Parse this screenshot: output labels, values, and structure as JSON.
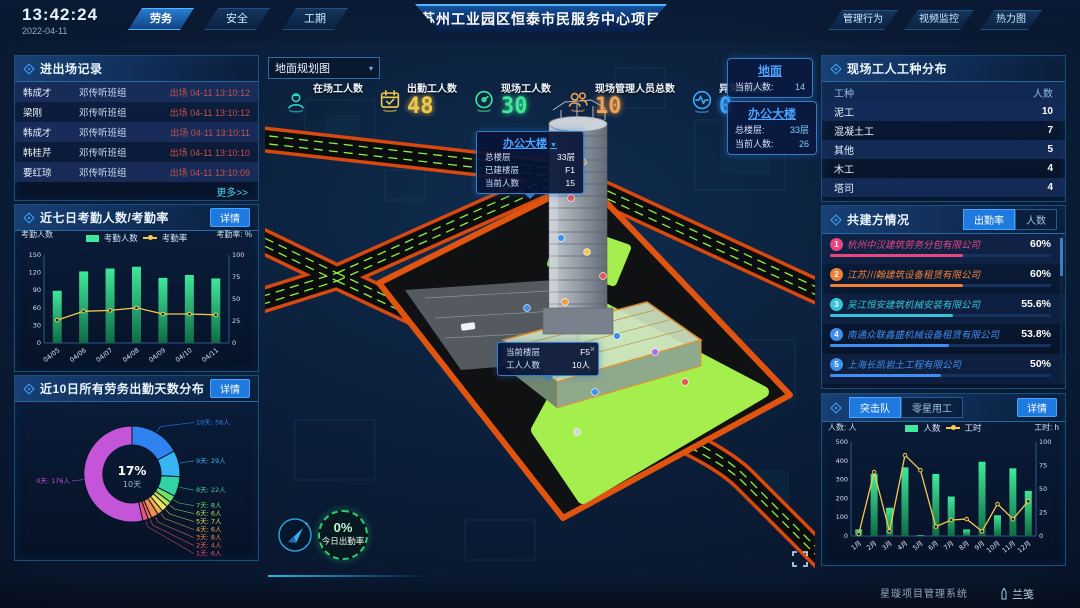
{
  "header": {
    "time": "13:42:24",
    "date": "2022-04-11",
    "nav_tabs": [
      "劳务",
      "安全",
      "工期"
    ],
    "title": "苏州工业园区恒泰市民服务中心项目",
    "right_tabs": [
      "管理行为",
      "视频监控",
      "热力图"
    ]
  },
  "entry_exit_panel": {
    "title": "进出场记录",
    "more_label": "更多>>",
    "rows": [
      {
        "name": "韩成才",
        "group": "邓传听班组",
        "status": "出场 04-11 13:10:12"
      },
      {
        "name": "梁刚",
        "group": "邓传听班组",
        "status": "出场 04-11 13:10:12"
      },
      {
        "name": "韩成才",
        "group": "邓传听班组",
        "status": "出场 04-11 13:10:11"
      },
      {
        "name": "韩桂芹",
        "group": "邓传听班组",
        "status": "出场 04-11 13:10:10"
      },
      {
        "name": "要红琼",
        "group": "邓传听班组",
        "status": "出场 04-11 13:10:09"
      }
    ]
  },
  "attendance_panel": {
    "title": "近七日考勤人数/考勤率",
    "detail_label": "详情"
  },
  "distribution_panel": {
    "title": "近10日所有劳务出勤天数分布",
    "detail_label": "详情"
  },
  "worker_type_panel": {
    "title": "现场工人工种分布",
    "headers": [
      "工种",
      "人数"
    ],
    "rows": [
      [
        "泥工",
        "10"
      ],
      [
        "混凝土工",
        "7"
      ],
      [
        "其他",
        "5"
      ],
      [
        "木工",
        "4"
      ],
      [
        "塔司",
        "4"
      ]
    ]
  },
  "partners_panel": {
    "title": "共建方情况",
    "tabs": [
      "出勤率",
      "人数"
    ],
    "active_tab": "出勤率",
    "rows": [
      {
        "rank": "1",
        "name": "杭州中汉建筑劳务分包有限公司",
        "percent": "60%",
        "value": 60,
        "color": "#e8467c"
      },
      {
        "rank": "2",
        "name": "江苏川翰建筑设备租赁有限公司",
        "percent": "60%",
        "value": 60,
        "color": "#f08038"
      },
      {
        "rank": "3",
        "name": "吴江恒安建筑机械安装有限公司",
        "percent": "55.6%",
        "value": 55.6,
        "color": "#35c5d8"
      },
      {
        "rank": "4",
        "name": "南通众联鑫盛机械设备租赁有限公司",
        "percent": "53.8%",
        "value": 53.8,
        "color": "#3f8ef0"
      },
      {
        "rank": "5",
        "name": "上海长凯岩土工程有限公司",
        "percent": "50%",
        "value": 50,
        "color": "#3f8ef0"
      },
      {
        "rank": "6",
        "name": "江苏洁绍建筑安装工程有限公司",
        "percent": "35.4%",
        "value": 35.4,
        "color": "#7b52d8"
      }
    ]
  },
  "assault_panel": {
    "tabs": [
      "突击队",
      "零星用工"
    ],
    "active_tab": "突击队",
    "detail_label": "详情"
  },
  "stats": [
    {
      "label": "在场工人数",
      "value": "",
      "icon": "worker-icon",
      "color": "#2fd8c8"
    },
    {
      "label": "出勤工人数",
      "value": "48",
      "icon": "calendar-check-icon",
      "color": "#f2c94c"
    },
    {
      "label": "现场工人数",
      "value": "30",
      "icon": "gauge-icon",
      "color": "#3fe89a"
    },
    {
      "label": "现场管理人员总数",
      "value": "10",
      "icon": "people-icon",
      "color": "#f2a254"
    },
    {
      "label": "异常出勤数",
      "value": "0",
      "icon": "pulse-icon",
      "color": "#3fa9ff"
    }
  ],
  "map": {
    "view_select": {
      "value": "地面规划图",
      "caret": "▾"
    },
    "building_tooltip": {
      "title": "办公大楼",
      "caret": "▼",
      "rows": [
        {
          "label": "总楼层",
          "value": "33层"
        },
        {
          "label": "已建楼层",
          "value": "F1"
        },
        {
          "label": "当前人数",
          "value": "15"
        }
      ]
    },
    "floor_tooltip": {
      "close": "×",
      "rows": [
        {
          "label": "当前楼层",
          "value": "F5"
        },
        {
          "label": "工人人数",
          "value": "10人"
        }
      ]
    },
    "info_boxes": [
      {
        "title": "地面",
        "rows": [
          {
            "label": "当前人数:",
            "value": "14"
          }
        ]
      },
      {
        "title": "办公大楼",
        "rows": [
          {
            "label": "总楼层:",
            "value": "33层"
          },
          {
            "label": "当前人数:",
            "value": "26"
          }
        ]
      }
    ],
    "attendance_ring": {
      "percent": "0%",
      "label": "今日出勤率"
    }
  },
  "footer": {
    "system_name": "星璇项目管理系统",
    "brand": "兰笺"
  },
  "chart_data": [
    {
      "id": "weekly-attendance",
      "type": "bar",
      "title": "近七日考勤人数/考勤率",
      "categories": [
        "04/05",
        "04/06",
        "04/07",
        "04/08",
        "04/09",
        "04/10",
        "04/11"
      ],
      "series": [
        {
          "name": "考勤人数",
          "type": "bar",
          "axis": "left",
          "color": "#3fe89a",
          "values": [
            89,
            122,
            127,
            130,
            111,
            116,
            110
          ]
        },
        {
          "name": "考勤率",
          "type": "line",
          "axis": "right",
          "color": "#f2c94c",
          "values": [
            26,
            36,
            37,
            40,
            33,
            33,
            32
          ]
        }
      ],
      "left_axis": {
        "label": "考勤人数",
        "min": 0,
        "max": 150,
        "ticks": [
          0,
          30,
          60,
          90,
          120,
          150
        ]
      },
      "right_axis": {
        "label": "考勤率: %",
        "min": 0,
        "max": 100,
        "ticks": [
          0,
          25,
          50,
          75,
          100
        ]
      },
      "legend_position": "top",
      "grid": false
    },
    {
      "id": "attendance-days-distribution",
      "type": "pie",
      "title": "近10日所有劳务出勤天数分布",
      "center_percent": "17%",
      "center_label": "10天",
      "slices": [
        {
          "label": "10天",
          "count": "56人",
          "value": 56,
          "color": "#2f83f0"
        },
        {
          "label": "9天",
          "count": "29人",
          "value": 29,
          "color": "#36b5f2"
        },
        {
          "label": "8天",
          "count": "22人",
          "value": 22,
          "color": "#2fd3a6"
        },
        {
          "label": "7天",
          "count": "8人",
          "value": 8,
          "color": "#6ee06b"
        },
        {
          "label": "6天",
          "count": "6人",
          "value": 6,
          "color": "#b8e35c"
        },
        {
          "label": "5天",
          "count": "7人",
          "value": 7,
          "color": "#efe35a"
        },
        {
          "label": "4天",
          "count": "6人",
          "value": 6,
          "color": "#f2b14e"
        },
        {
          "label": "3天",
          "count": "8人",
          "value": 8,
          "color": "#f08a4b"
        },
        {
          "label": "2天",
          "count": "4人",
          "value": 4,
          "color": "#ef6a5a"
        },
        {
          "label": "1天",
          "count": "6人",
          "value": 6,
          "color": "#e8537a"
        },
        {
          "label": "0天",
          "count": "176人",
          "value": 176,
          "color": "#c455d8"
        }
      ]
    },
    {
      "id": "assault-team-monthly",
      "type": "bar",
      "title": "突击队",
      "categories": [
        "1月",
        "2月",
        "3月",
        "4月",
        "5月",
        "6月",
        "7月",
        "8月",
        "9月",
        "10月",
        "11月",
        "12月"
      ],
      "series": [
        {
          "name": "人数",
          "type": "bar",
          "axis": "left",
          "color": "#3fe89a",
          "values": [
            35,
            330,
            150,
            365,
            5,
            330,
            210,
            35,
            395,
            110,
            360,
            240
          ]
        },
        {
          "name": "工时",
          "type": "line",
          "axis": "right",
          "color": "#f2c94c",
          "values": [
            2,
            68,
            5,
            86,
            70,
            10,
            17,
            18,
            5,
            34,
            18,
            37
          ]
        }
      ],
      "left_axis": {
        "label": "人数: 人",
        "min": 0,
        "max": 500,
        "ticks": [
          0,
          100,
          200,
          300,
          400,
          500
        ]
      },
      "right_axis": {
        "label": "工时: h",
        "min": 0,
        "max": 100,
        "ticks": [
          0,
          25,
          50,
          75,
          100
        ]
      },
      "legend_position": "top",
      "grid": false
    }
  ]
}
